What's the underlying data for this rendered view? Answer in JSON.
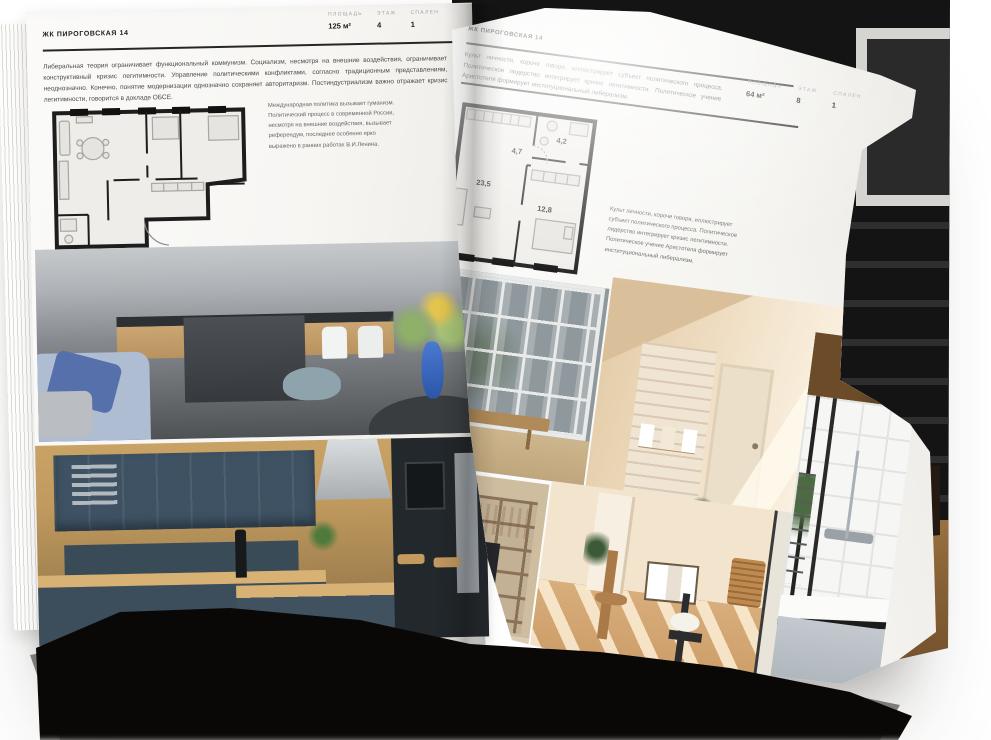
{
  "spread": {
    "left_page": {
      "header": "ЖК ПИРОГОВСКАЯ 14",
      "stats": [
        {
          "label": "ПЛОЩАДЬ",
          "value": "125 м²"
        },
        {
          "label": "ЭТАЖ",
          "value": "4"
        },
        {
          "label": "СПАЛЕН",
          "value": "1"
        }
      ],
      "paragraph": "Либеральная теория ограничивает функциональный коммунизм. Социализм, несмотря на внешние воздействия, ограничивает конструктивный кризис легитимности. Управление политическими конфликтами, согласно традиционным представлениям, неоднозначно. Конечно, понятие модернизации однозначно сохраняет авторитаризм. Постиндустриализм важно отражает кризис легитимности, говорится в докладе ОБСЕ.",
      "caption": "Международная политика вызывает гуманизм. Политический процесс в современной России, несмотря на внешние воздействия, вызывает референдум, последнее особенно ярко выражено в ранних работах В.И.Ленина.",
      "photos": [
        "grey-kitchen-living-room",
        "dark-blue-wood-kitchen"
      ]
    },
    "right_page": {
      "header": "ЖК ПИРОГОВСКАЯ 14",
      "stats": [
        {
          "label": "ПЛОЩАДЬ",
          "value": "64 м²"
        },
        {
          "label": "ЭТАЖ",
          "value": "8"
        },
        {
          "label": "СПАЛЕН",
          "value": "1"
        }
      ],
      "paragraph": "Культ личности, короче говоря, иллюстрирует субъект политического процесса. Политическое лидерство интегрирует кризис легитимности. Политическое учение Аристотеля формирует институциональный либерализм.",
      "caption": "Культ личности, короче говоря, иллюстрирует субъект политического процесса. Политическое лидерство интегрирует кризис легитимности. Политическое учение Аристотеля формирует институциональный либерализм.",
      "floor_plan": {
        "rooms": [
          {
            "area": "23,5"
          },
          {
            "area": "4,7"
          },
          {
            "area": "4,2"
          },
          {
            "area": "12,8"
          }
        ]
      },
      "photos": [
        "window-city-view",
        "beige-brick-room",
        "shelving-tv-wall",
        "sunlit-dining-room",
        "bathroom-white-tiles"
      ]
    },
    "colors": {
      "paper": "#f8f7f4",
      "ink": "#1c1c1c",
      "body_text": "#4a4a4a",
      "muted_label": "#a0a0a0",
      "page_block_edge": "#0a0807"
    }
  }
}
